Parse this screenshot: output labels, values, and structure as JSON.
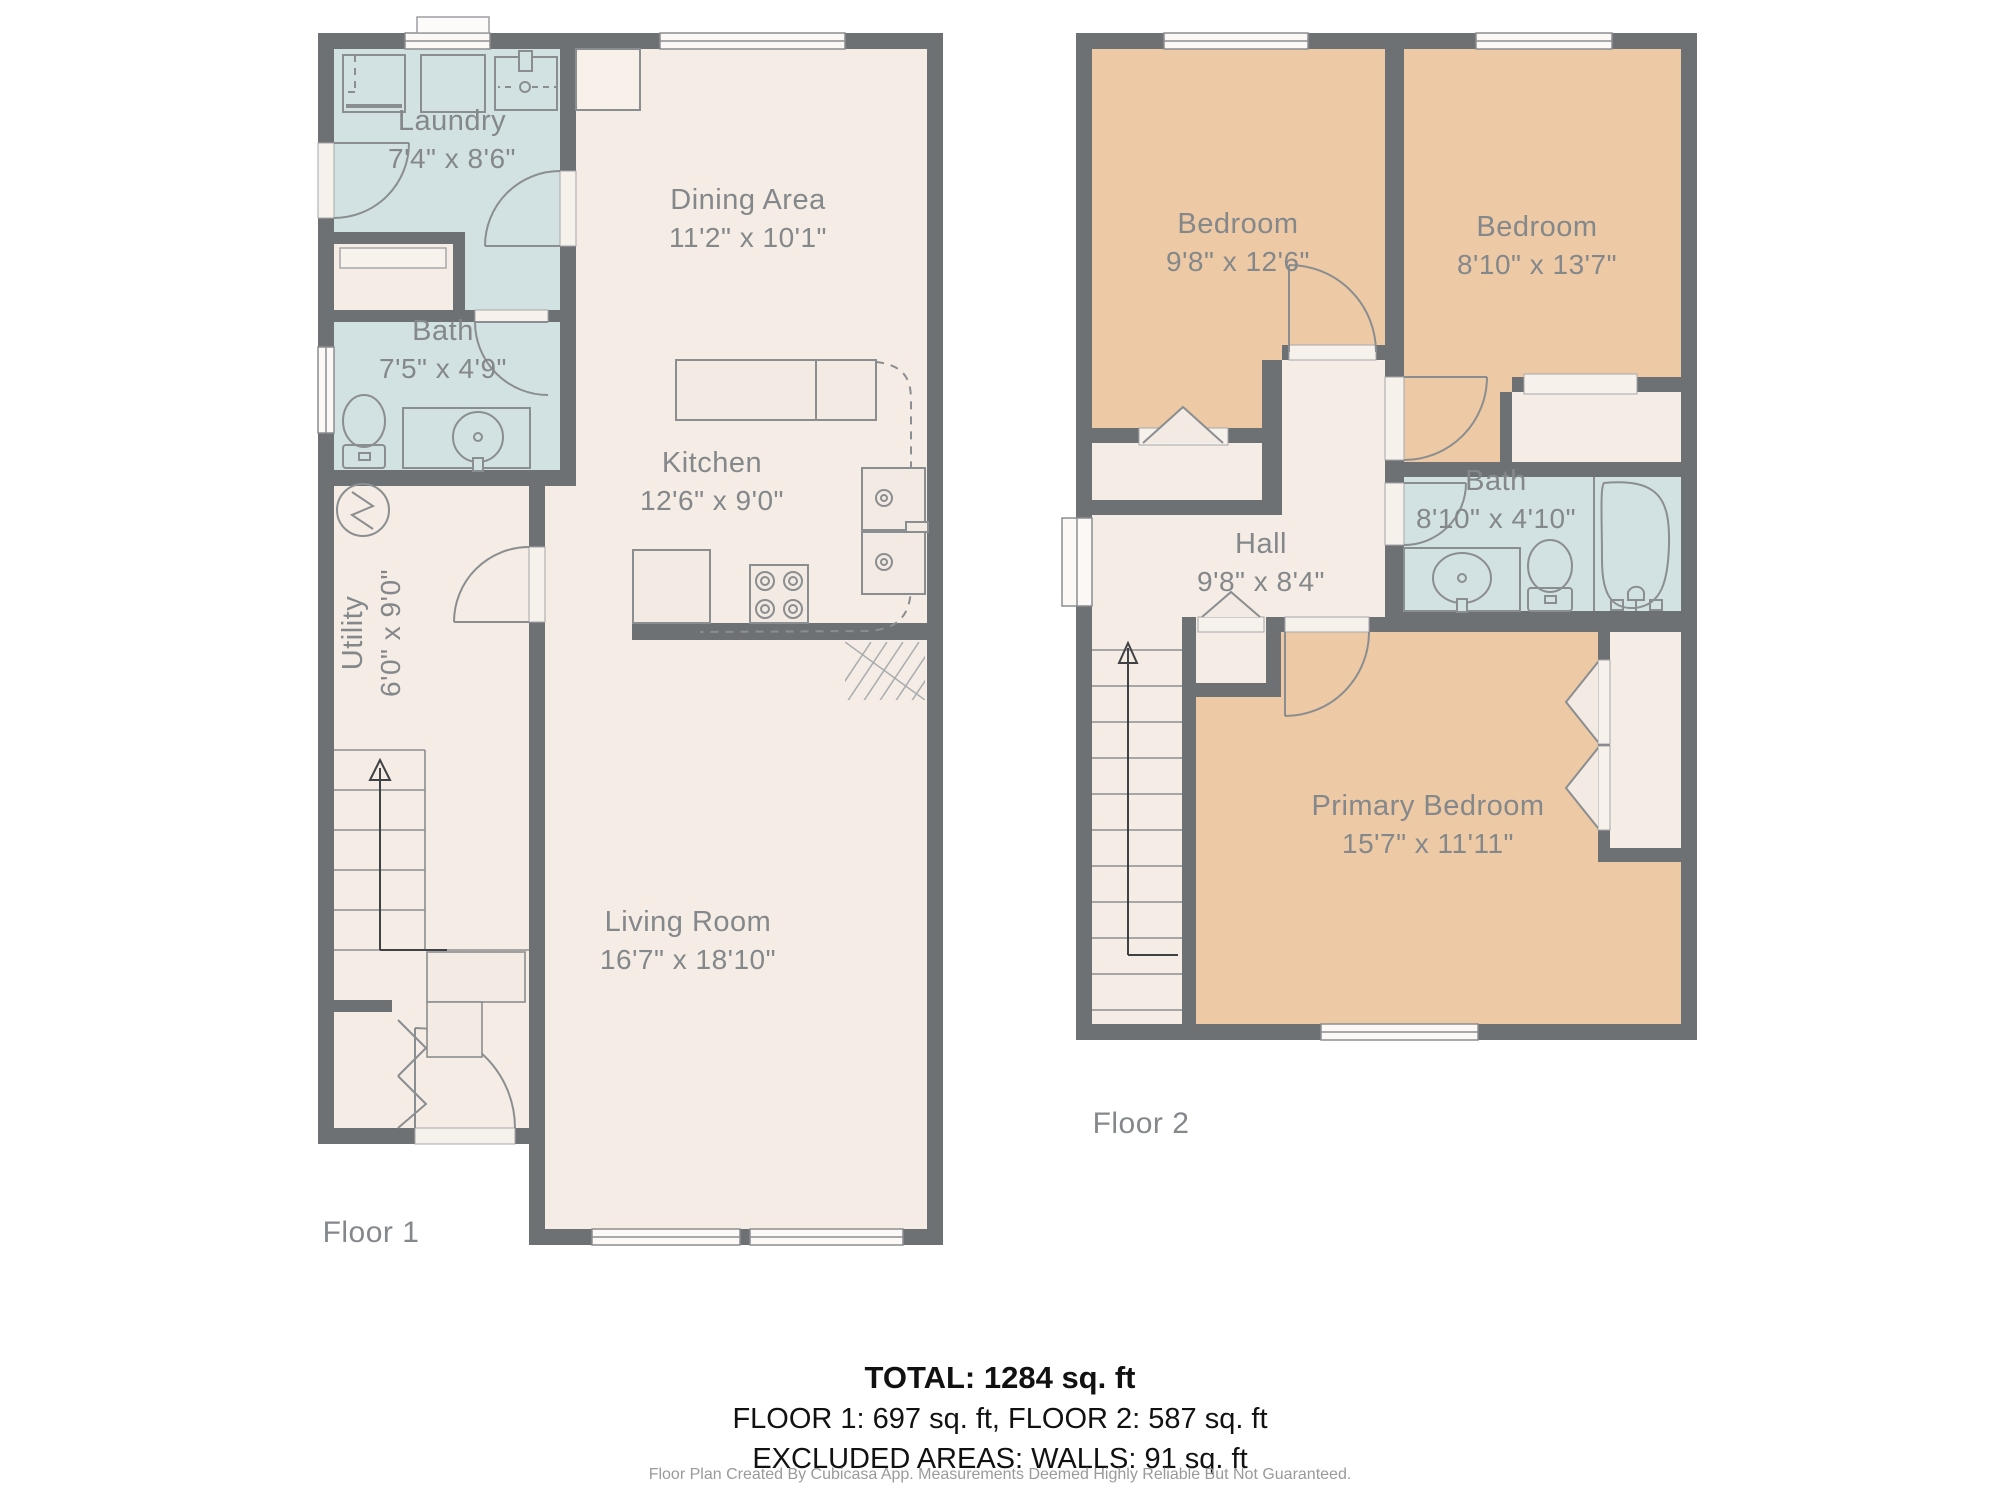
{
  "colors": {
    "wall": "#6e7174",
    "floor": "#f4ece5",
    "wet_room": "#d2e1e2",
    "bedroom": "#edcaa5",
    "label_text": "#84888b",
    "fixture_line": "#8b8e90",
    "summary_text": "#111111",
    "disclaimer_text": "#9a9a9a"
  },
  "floor1": {
    "label": "Floor 1",
    "rooms": [
      {
        "name": "Laundry",
        "dims": "7'4\" x 8'6\""
      },
      {
        "name": "Bath",
        "dims": "7'5\" x 4'9\""
      },
      {
        "name": "Dining Area",
        "dims": "11'2\" x 10'1\""
      },
      {
        "name": "Kitchen",
        "dims": "12'6\" x 9'0\""
      },
      {
        "name": "Utility",
        "dims": "6'0\" x 9'0\""
      },
      {
        "name": "Living Room",
        "dims": "16'7\" x 18'10\""
      }
    ],
    "icons": [
      "washer-icon",
      "dryer-icon",
      "laundry-sink-icon",
      "toilet-icon",
      "vanity-sink-icon",
      "water-heater-icon",
      "stairs-up-arrow-icon",
      "kitchen-counter-icon",
      "kitchen-sink-icon",
      "stove-icon",
      "refrigerator-icon",
      "door-swing-icon",
      "bifold-door-icon",
      "window-icon"
    ]
  },
  "floor2": {
    "label": "Floor 2",
    "rooms": [
      {
        "name": "Bedroom",
        "dims": "9'8\" x 12'6\""
      },
      {
        "name": "Bedroom",
        "dims": "8'10\" x 13'7\""
      },
      {
        "name": "Bath",
        "dims": "8'10\" x 4'10\""
      },
      {
        "name": "Hall",
        "dims": "9'8\" x 8'4\""
      },
      {
        "name": "Primary Bedroom",
        "dims": "15'7\" x 11'11\""
      }
    ],
    "icons": [
      "stairs-up-arrow-icon",
      "vanity-sink-icon",
      "toilet-icon",
      "bathtub-icon",
      "closet-fold-door-icon",
      "door-swing-icon",
      "window-icon"
    ]
  },
  "summary": {
    "total": "TOTAL: 1284 sq. ft",
    "floors": "FLOOR 1: 697 sq. ft, FLOOR 2: 587 sq. ft",
    "excluded": "EXCLUDED AREAS: WALLS: 91 sq. ft",
    "disclaimer": "Floor Plan Created By Cubicasa App. Measurements Deemed Highly Reliable But Not Guaranteed."
  }
}
